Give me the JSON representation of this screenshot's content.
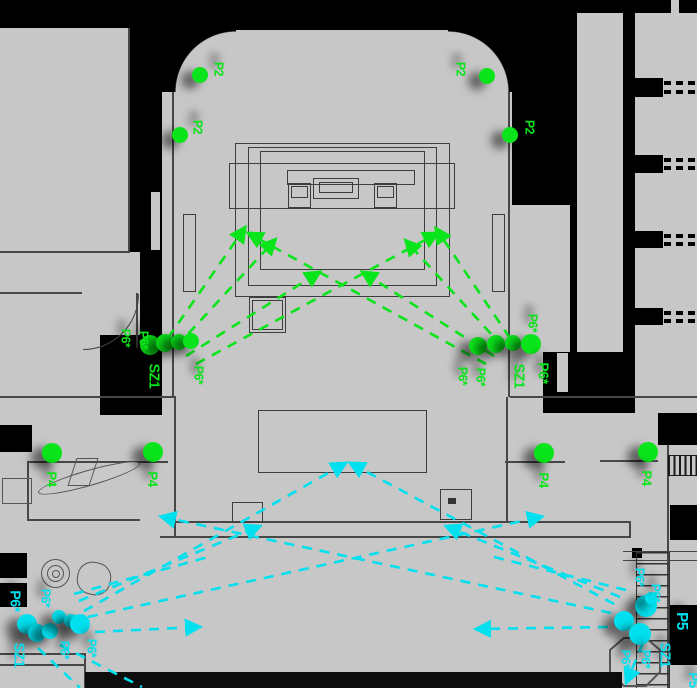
{
  "meta": {
    "description": "floor plan with device placement annotations"
  },
  "colors": {
    "green": "#0ae41a",
    "cyan": "#00e0ee",
    "background": "#c7c7c7",
    "wall": "#000000",
    "line": "#474747"
  },
  "annotations": {
    "labels": [
      {
        "t": "P2",
        "x": 219,
        "y": 69,
        "c": "green",
        "s": 13
      },
      {
        "t": "P2",
        "x": 198,
        "y": 127,
        "c": "green",
        "s": 13
      },
      {
        "t": "P2",
        "x": 461,
        "y": 69,
        "c": "green",
        "s": 13
      },
      {
        "t": "P2",
        "x": 530,
        "y": 127,
        "c": "green",
        "s": 13
      },
      {
        "t": "P6*",
        "x": 126,
        "y": 338,
        "c": "green",
        "s": 13
      },
      {
        "t": "P6*",
        "x": 144,
        "y": 340,
        "c": "green",
        "s": 13
      },
      {
        "t": "SZ1",
        "x": 154,
        "y": 376,
        "c": "green",
        "s": 15
      },
      {
        "t": "P6*",
        "x": 199,
        "y": 375,
        "c": "green",
        "s": 13
      },
      {
        "t": "P6*",
        "x": 533,
        "y": 323,
        "c": "green",
        "s": 13
      },
      {
        "t": "P6*",
        "x": 463,
        "y": 376,
        "c": "green",
        "s": 13
      },
      {
        "t": "P6*",
        "x": 481,
        "y": 377,
        "c": "green",
        "s": 13
      },
      {
        "t": "SZ1",
        "x": 519,
        "y": 376,
        "c": "green",
        "s": 15
      },
      {
        "t": "P6*",
        "x": 543,
        "y": 373,
        "c": "green",
        "s": 15
      },
      {
        "t": "P4",
        "x": 52,
        "y": 479,
        "c": "green",
        "s": 14
      },
      {
        "t": "P4",
        "x": 153,
        "y": 479,
        "c": "green",
        "s": 14
      },
      {
        "t": "P4",
        "x": 544,
        "y": 480,
        "c": "green",
        "s": 14
      },
      {
        "t": "P4",
        "x": 647,
        "y": 478,
        "c": "green",
        "s": 14
      },
      {
        "t": "P6*",
        "x": 15,
        "y": 601,
        "c": "cyan",
        "s": 15
      },
      {
        "t": "P6*",
        "x": 46,
        "y": 598,
        "c": "cyan",
        "s": 13
      },
      {
        "t": "SZ1",
        "x": 19,
        "y": 655,
        "c": "cyan",
        "s": 15
      },
      {
        "t": "P6*",
        "x": 65,
        "y": 650,
        "c": "cyan",
        "s": 13
      },
      {
        "t": "P6*",
        "x": 92,
        "y": 648,
        "c": "cyan",
        "s": 13
      },
      {
        "t": "P6*",
        "x": 640,
        "y": 577,
        "c": "cyan",
        "s": 13
      },
      {
        "t": "P6*",
        "x": 656,
        "y": 593,
        "c": "cyan",
        "s": 13
      },
      {
        "t": "SZ1",
        "x": 665,
        "y": 655,
        "c": "cyan",
        "s": 15
      },
      {
        "t": "P6*",
        "x": 646,
        "y": 659,
        "c": "cyan",
        "s": 13
      },
      {
        "t": "P6*",
        "x": 626,
        "y": 659,
        "c": "cyan",
        "s": 13
      },
      {
        "t": "P5",
        "x": 681,
        "y": 621,
        "c": "cyan",
        "s": 16
      },
      {
        "t": "P5",
        "x": 694,
        "y": 680,
        "c": "cyan",
        "s": 14
      }
    ],
    "dots": [
      {
        "x": 200,
        "y": 75,
        "r": 8,
        "c": "green"
      },
      {
        "x": 180,
        "y": 135,
        "r": 8,
        "c": "green"
      },
      {
        "x": 487,
        "y": 76,
        "r": 8,
        "c": "green"
      },
      {
        "x": 510,
        "y": 135,
        "r": 8,
        "c": "green"
      },
      {
        "x": 150,
        "y": 345,
        "r": 10,
        "c": "green"
      },
      {
        "x": 165,
        "y": 343,
        "r": 9,
        "c": "green"
      },
      {
        "x": 179,
        "y": 342,
        "r": 8,
        "c": "green"
      },
      {
        "x": 191,
        "y": 341,
        "r": 8,
        "c": "green"
      },
      {
        "x": 478,
        "y": 346,
        "r": 9,
        "c": "green"
      },
      {
        "x": 496,
        "y": 344,
        "r": 9,
        "c": "green"
      },
      {
        "x": 513,
        "y": 343,
        "r": 8,
        "c": "green"
      },
      {
        "x": 531,
        "y": 344,
        "r": 10,
        "c": "green"
      },
      {
        "x": 52,
        "y": 453,
        "r": 10,
        "c": "green"
      },
      {
        "x": 153,
        "y": 452,
        "r": 10,
        "c": "green"
      },
      {
        "x": 544,
        "y": 453,
        "r": 10,
        "c": "green"
      },
      {
        "x": 648,
        "y": 452,
        "r": 10,
        "c": "green"
      },
      {
        "x": 27,
        "y": 624,
        "r": 10,
        "c": "cyan"
      },
      {
        "x": 37,
        "y": 633,
        "r": 9,
        "c": "cyan"
      },
      {
        "x": 50,
        "y": 631,
        "r": 8,
        "c": "cyan"
      },
      {
        "x": 59,
        "y": 617,
        "r": 7,
        "c": "cyan"
      },
      {
        "x": 71,
        "y": 621,
        "r": 7,
        "c": "cyan"
      },
      {
        "x": 80,
        "y": 624,
        "r": 10,
        "c": "cyan"
      },
      {
        "x": 646,
        "y": 606,
        "r": 11,
        "c": "cyan"
      },
      {
        "x": 624,
        "y": 621,
        "r": 10,
        "c": "cyan"
      },
      {
        "x": 640,
        "y": 634,
        "r": 11,
        "c": "cyan"
      },
      {
        "x": 651,
        "y": 598,
        "r": 6,
        "c": "cyan"
      }
    ],
    "arrows": [
      {
        "x1": 168,
        "y1": 338,
        "x2": 244,
        "y2": 229,
        "c": "green",
        "head": true
      },
      {
        "x1": 176,
        "y1": 347,
        "x2": 274,
        "y2": 241,
        "c": "green",
        "head": true
      },
      {
        "x1": 186,
        "y1": 356,
        "x2": 318,
        "y2": 273,
        "c": "green",
        "head": true
      },
      {
        "x1": 196,
        "y1": 364,
        "x2": 436,
        "y2": 234,
        "c": "green",
        "head": true
      },
      {
        "x1": 510,
        "y1": 338,
        "x2": 437,
        "y2": 230,
        "c": "green",
        "head": true
      },
      {
        "x1": 503,
        "y1": 347,
        "x2": 407,
        "y2": 242,
        "c": "green",
        "head": true
      },
      {
        "x1": 494,
        "y1": 356,
        "x2": 364,
        "y2": 273,
        "c": "green",
        "head": true
      },
      {
        "x1": 486,
        "y1": 364,
        "x2": 250,
        "y2": 234,
        "c": "green",
        "head": true
      },
      {
        "x1": 95,
        "y1": 632,
        "x2": 198,
        "y2": 627,
        "c": "cyan",
        "head": true
      },
      {
        "x1": 84,
        "y1": 611,
        "x2": 344,
        "y2": 464,
        "c": "cyan",
        "head": true
      },
      {
        "x1": 88,
        "y1": 617,
        "x2": 540,
        "y2": 517,
        "c": "cyan",
        "head": true
      },
      {
        "x1": 79,
        "y1": 601,
        "x2": 258,
        "y2": 527,
        "c": "cyan",
        "head": true
      },
      {
        "x1": 74,
        "y1": 594,
        "x2": 212,
        "y2": 556,
        "c": "cyan",
        "head": false
      },
      {
        "x1": 60,
        "y1": 645,
        "x2": 142,
        "y2": 687,
        "c": "cyan",
        "head": false
      },
      {
        "x1": 38,
        "y1": 648,
        "x2": 80,
        "y2": 688,
        "c": "cyan",
        "head": false
      },
      {
        "x1": 608,
        "y1": 627,
        "x2": 478,
        "y2": 629,
        "c": "cyan",
        "head": true
      },
      {
        "x1": 614,
        "y1": 604,
        "x2": 352,
        "y2": 464,
        "c": "cyan",
        "head": true
      },
      {
        "x1": 611,
        "y1": 613,
        "x2": 163,
        "y2": 517,
        "c": "cyan",
        "head": true
      },
      {
        "x1": 620,
        "y1": 597,
        "x2": 448,
        "y2": 527,
        "c": "cyan",
        "head": true
      },
      {
        "x1": 626,
        "y1": 590,
        "x2": 490,
        "y2": 556,
        "c": "cyan",
        "head": false
      },
      {
        "x1": 643,
        "y1": 643,
        "x2": 627,
        "y2": 681,
        "c": "cyan",
        "head": true
      }
    ]
  }
}
